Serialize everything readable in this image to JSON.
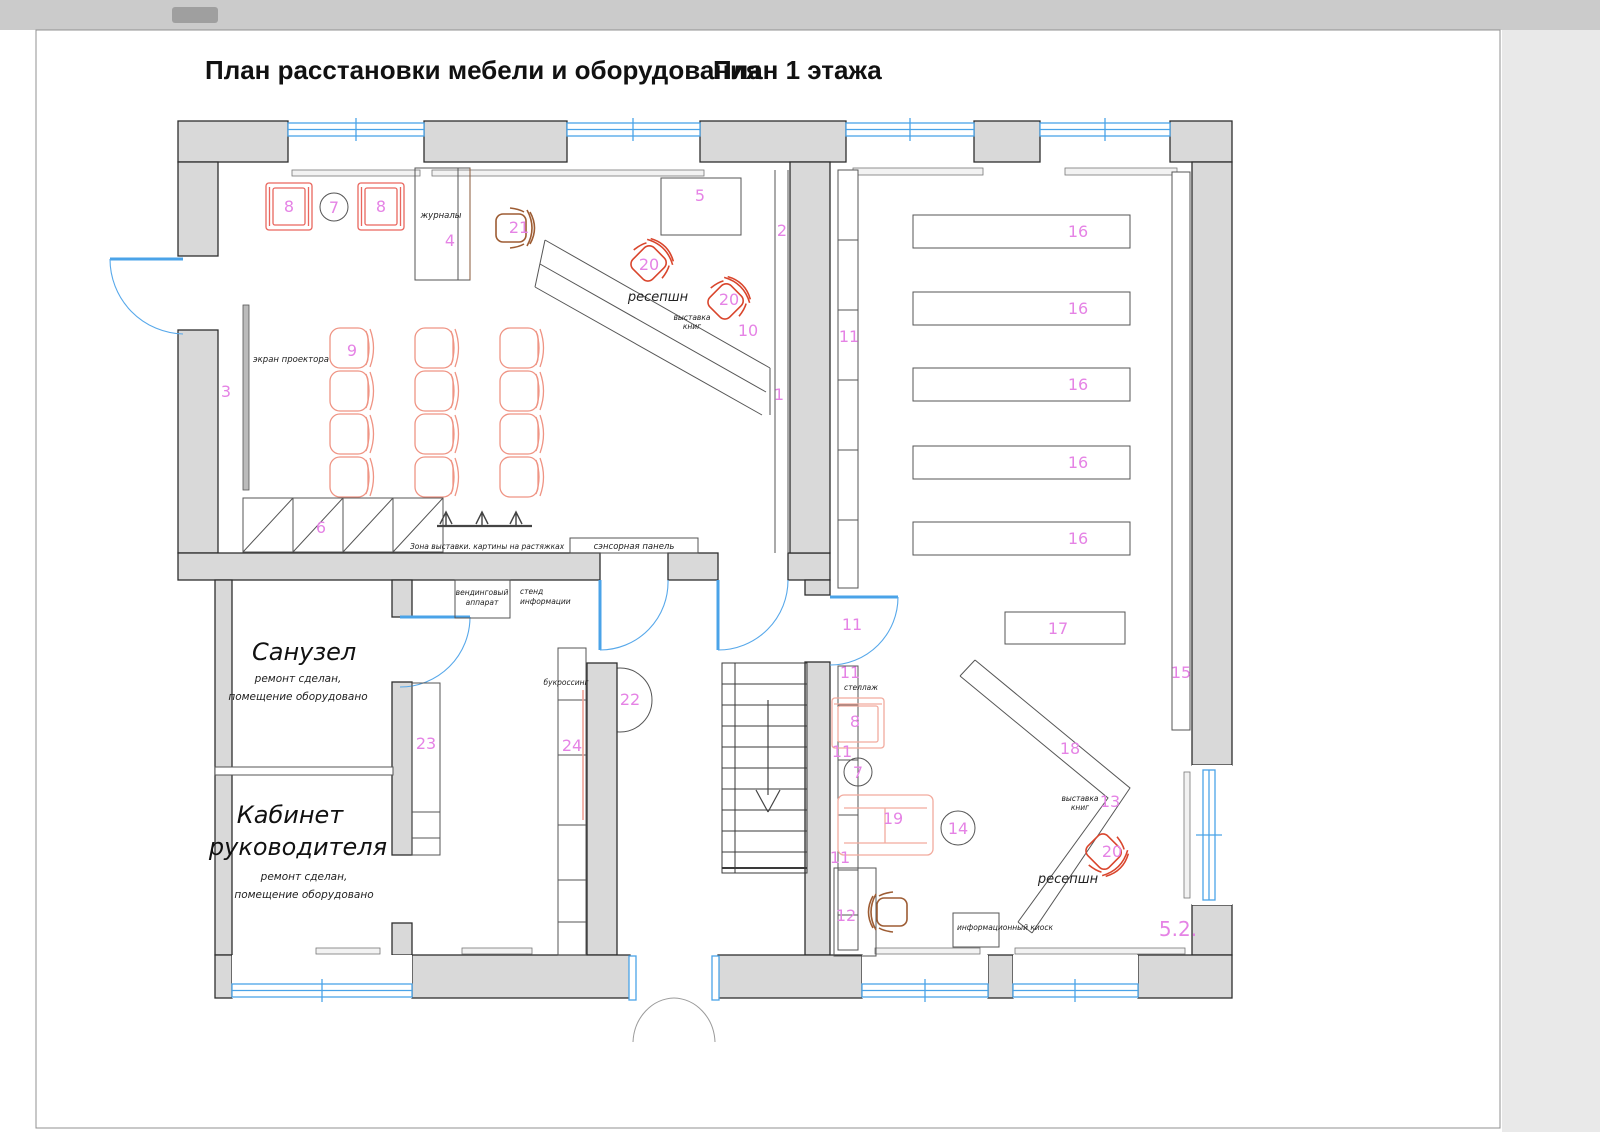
{
  "title": {
    "main": "План расстановки мебели и оборудования",
    "floor": "План 1 этажа"
  },
  "rooms": {
    "bathroom": {
      "name": "Санузел",
      "note1": "ремонт сделан,",
      "note2": "помещение оборудовано"
    },
    "office": {
      "name_line1": "Кабинет",
      "name_line2": "руководителя",
      "note1": "ремонт сделан,",
      "note2": "помещение оборудовано"
    }
  },
  "annotations": {
    "magazines": "журналы",
    "reception": "ресепшн",
    "book_exhibit_line1": "выставка",
    "book_exhibit_line2": "книг",
    "projector_screen": "экран проектора",
    "exhibition_zone": "Зона выставки.  картины на растяжках",
    "touch_panel": "сэнсорная панель",
    "vending_line1": "вендинговый",
    "vending_line2": "аппарат",
    "info_stand_line1": "стенд",
    "info_stand_line2": "информации",
    "bookcrossing": "букроссинг",
    "shelving": "стеллаж",
    "info_kiosk": "информационный киоск"
  },
  "numbers": {
    "n1": "1",
    "n2": "2",
    "n3": "3",
    "n4": "4",
    "n5": "5",
    "n6": "6",
    "n7": "7",
    "n8": "8",
    "n9": "9",
    "n10": "10",
    "n11": "11",
    "n12": "12",
    "n13": "13",
    "n14": "14",
    "n15": "15",
    "n16": "16",
    "n17": "17",
    "n18": "18",
    "n19": "19",
    "n20": "20",
    "n21": "21",
    "n22": "22",
    "n23": "23",
    "n24": "24",
    "n52": "5.2."
  },
  "colors": {
    "wall_fill": "#d9d9d9",
    "wall_stroke": "#2e2e2e",
    "window_blue": "#4aa3e8",
    "label_pink": "#e583e5",
    "chair_salmon": "#ef9484",
    "armchair_red": "#e9665e",
    "office_chair_orange": "#d9452c",
    "office_chair_brown": "#9d5c33",
    "sofa_pale": "#f2ab9e"
  }
}
